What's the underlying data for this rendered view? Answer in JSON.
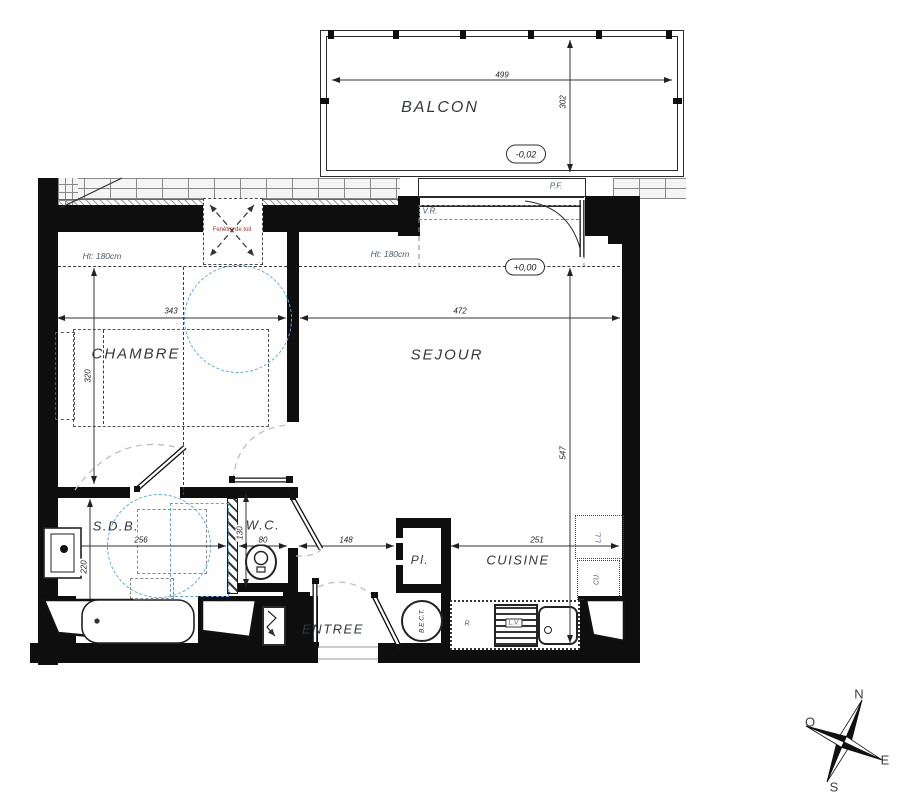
{
  "title": "Plan d'appartement - studio avec balcon",
  "colors": {
    "wall": "#0e0e0e",
    "line": "#2a2a2a",
    "clearance_blue": "#58a7ee",
    "swing_gray": "#bdbdbd",
    "roof_window_red": "#a8332e",
    "tech_label": "#4a5a70"
  },
  "rooms": {
    "balcon": "BALCON",
    "chambre": "CHAMBRE",
    "sejour": "SEJOUR",
    "sdb": "S.D.B.",
    "wc": "W.C.",
    "entree": "ENTREE",
    "cuisine": "CUISINE",
    "placard": "Pl."
  },
  "levels": {
    "balcony": "-0,02",
    "interior": "+0,00"
  },
  "annotations": {
    "pf": "P.F.",
    "vr": "V.R.",
    "ht_left": "Ht: 180cm",
    "ht_right": "Ht: 180cm",
    "roof_window": "Fenêtre de toit",
    "refrigerator": "R.",
    "dishwasher": "L.V.",
    "washing_machine": "L.L.",
    "cooker": "CU.",
    "water_heater": "B.E.C.T."
  },
  "dimensions": {
    "balcony_width": "499",
    "balcony_depth": "302",
    "chambre_width": "343",
    "sejour_width": "472",
    "chambre_depth": "320",
    "sejour_depth": "547",
    "sdb_width": "256",
    "sdb_depth": "220",
    "wc_depth": "130",
    "wc_width": "80",
    "entree_width": "148",
    "cuisine_width": "251"
  },
  "compass": {
    "n": "N",
    "o": "O",
    "e": "E",
    "s": "S"
  }
}
